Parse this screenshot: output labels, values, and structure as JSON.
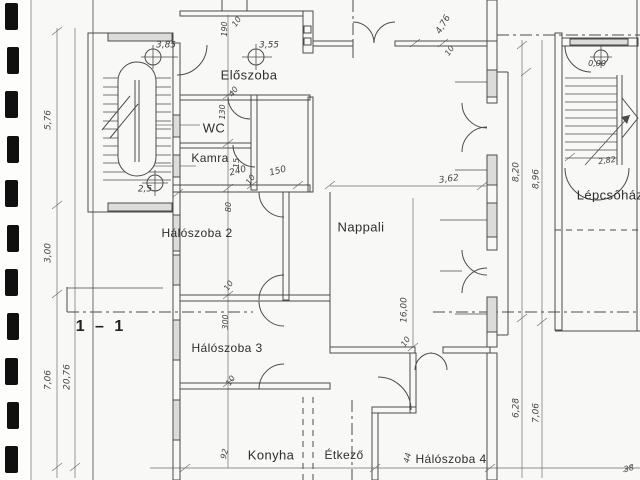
{
  "colors": {
    "ink": "#4b4b4b",
    "paper": "#f8f8f6",
    "binder_mark": "#101010"
  },
  "labels": [
    {
      "id": "room-label-eloszoba",
      "kind": "room",
      "label": "Előszoba",
      "x": 249,
      "y": 75,
      "size": 13
    },
    {
      "id": "room-label-wc",
      "kind": "room",
      "label": "WC",
      "x": 214,
      "y": 128,
      "size": 13
    },
    {
      "id": "room-label-kamra",
      "kind": "room",
      "label": "Kamra",
      "x": 210,
      "y": 158,
      "size": 12
    },
    {
      "id": "room-label-haloszoba-2",
      "kind": "room",
      "label": "Hálószoba 2",
      "x": 197,
      "y": 233,
      "size": 12
    },
    {
      "id": "room-label-nappali",
      "kind": "room",
      "label": "Nappali",
      "x": 361,
      "y": 227,
      "size": 13
    },
    {
      "id": "room-label-haloszoba-3",
      "kind": "room",
      "label": "Hálószoba 3",
      "x": 227,
      "y": 348,
      "size": 12
    },
    {
      "id": "room-label-konyha",
      "kind": "room",
      "label": "Konyha",
      "x": 271,
      "y": 455,
      "size": 13
    },
    {
      "id": "room-label-etkezo",
      "kind": "room",
      "label": "Étkező",
      "x": 344,
      "y": 455,
      "size": 12
    },
    {
      "id": "room-label-haloszoba-4",
      "kind": "room",
      "label": "Hálószoba 4",
      "x": 451,
      "y": 459,
      "size": 12
    },
    {
      "id": "room-label-lepcsohaz",
      "kind": "room",
      "label": "Lépcsőház",
      "x": 610,
      "y": 195,
      "size": 13
    },
    {
      "id": "level-stair-left-top",
      "kind": "level",
      "label": "3,85",
      "x": 166,
      "y": 46,
      "size": 9
    },
    {
      "id": "level-eloszoba",
      "kind": "level",
      "label": "3,55",
      "x": 269,
      "y": 46,
      "size": 9
    },
    {
      "id": "level-stair-left-bottom",
      "kind": "level",
      "label": "2,5",
      "x": 145,
      "y": 190,
      "size": 9
    },
    {
      "id": "level-lepcsohaz",
      "kind": "level",
      "label": "0,00",
      "x": 597,
      "y": 64,
      "size": 8
    },
    {
      "id": "section-label",
      "kind": "section-lbl",
      "label": "1 – 1",
      "x": 101,
      "y": 327,
      "size": 16
    },
    {
      "id": "dim-5-76",
      "kind": "dim",
      "label": "5,76",
      "x": 49,
      "y": 120,
      "rot": -90
    },
    {
      "id": "dim-3-00",
      "kind": "dim",
      "label": "3,00",
      "x": 49,
      "y": 253,
      "rot": -90
    },
    {
      "id": "dim-7-06-left",
      "kind": "dim",
      "label": "7,06",
      "x": 49,
      "y": 380,
      "rot": -90
    },
    {
      "id": "dim-20-76",
      "kind": "dim",
      "label": "20,76",
      "x": 68,
      "y": 377,
      "rot": -90
    },
    {
      "id": "dim-190",
      "kind": "dim",
      "label": "190",
      "x": 225,
      "y": 29,
      "rot": -90,
      "size": 8
    },
    {
      "id": "dim-10-top",
      "kind": "dim",
      "label": "10",
      "x": 237,
      "y": 22,
      "rot": -55,
      "size": 8
    },
    {
      "id": "dim-40",
      "kind": "dim",
      "label": "40",
      "x": 234,
      "y": 92,
      "rot": -55,
      "size": 8
    },
    {
      "id": "dim-130",
      "kind": "dim",
      "label": "130",
      "x": 223,
      "y": 112,
      "rot": -90,
      "size": 8
    },
    {
      "id": "dim-15",
      "kind": "dim",
      "label": "15",
      "x": 237,
      "y": 163,
      "rot": -90,
      "size": 8
    },
    {
      "id": "dim-240",
      "kind": "dim",
      "label": "240",
      "x": 238,
      "y": 172,
      "rot": -15
    },
    {
      "id": "dim-10-kamra",
      "kind": "dim",
      "label": "10",
      "x": 251,
      "y": 180,
      "rot": -55,
      "size": 8
    },
    {
      "id": "dim-150",
      "kind": "dim",
      "label": "150",
      "x": 278,
      "y": 172,
      "rot": -15
    },
    {
      "id": "dim-80",
      "kind": "dim",
      "label": "80",
      "x": 229,
      "y": 207,
      "rot": -90,
      "size": 8
    },
    {
      "id": "dim-10-h2",
      "kind": "dim",
      "label": "10",
      "x": 229,
      "y": 286,
      "rot": -55,
      "size": 8
    },
    {
      "id": "dim-300-h3",
      "kind": "dim",
      "label": "300",
      "x": 226,
      "y": 322,
      "rot": -90,
      "size": 8
    },
    {
      "id": "dim-10-h3",
      "kind": "dim",
      "label": "10",
      "x": 231,
      "y": 381,
      "rot": -55,
      "size": 8
    },
    {
      "id": "dim-3-62",
      "kind": "dim",
      "label": "3,62",
      "x": 449,
      "y": 180,
      "rot": -8
    },
    {
      "id": "dim-8-20",
      "kind": "dim",
      "label": "8,20",
      "x": 517,
      "y": 172,
      "rot": -90
    },
    {
      "id": "dim-8-96",
      "kind": "dim",
      "label": "8,96",
      "x": 537,
      "y": 179,
      "rot": -90
    },
    {
      "id": "dim-4-76",
      "kind": "dim",
      "label": "4,76",
      "x": 444,
      "y": 25,
      "rot": -60
    },
    {
      "id": "dim-10-nappali-top",
      "kind": "dim",
      "label": "10",
      "x": 450,
      "y": 51,
      "rot": -55,
      "size": 8
    },
    {
      "id": "dim-16-00",
      "kind": "dim",
      "label": "16,00",
      "x": 405,
      "y": 310,
      "rot": -90
    },
    {
      "id": "dim-10-etkezo",
      "kind": "dim",
      "label": "10",
      "x": 406,
      "y": 342,
      "rot": -55,
      "size": 8
    },
    {
      "id": "dim-2-82",
      "kind": "dim",
      "label": "2,82",
      "x": 607,
      "y": 161,
      "rot": -8,
      "size": 8
    },
    {
      "id": "dim-6-28",
      "kind": "dim",
      "label": "6,28",
      "x": 517,
      "y": 408,
      "rot": -90
    },
    {
      "id": "dim-7-06-right",
      "kind": "dim",
      "label": "7,06",
      "x": 537,
      "y": 413,
      "rot": -90
    },
    {
      "id": "dim-92",
      "kind": "dim",
      "label": "92",
      "x": 225,
      "y": 454,
      "rot": -75,
      "size": 8
    },
    {
      "id": "dim-44",
      "kind": "dim",
      "label": "44",
      "x": 408,
      "y": 458,
      "rot": -75,
      "size": 8
    },
    {
      "id": "dim-38",
      "kind": "dim",
      "label": "38",
      "x": 629,
      "y": 469,
      "rot": -15,
      "size": 8
    }
  ]
}
